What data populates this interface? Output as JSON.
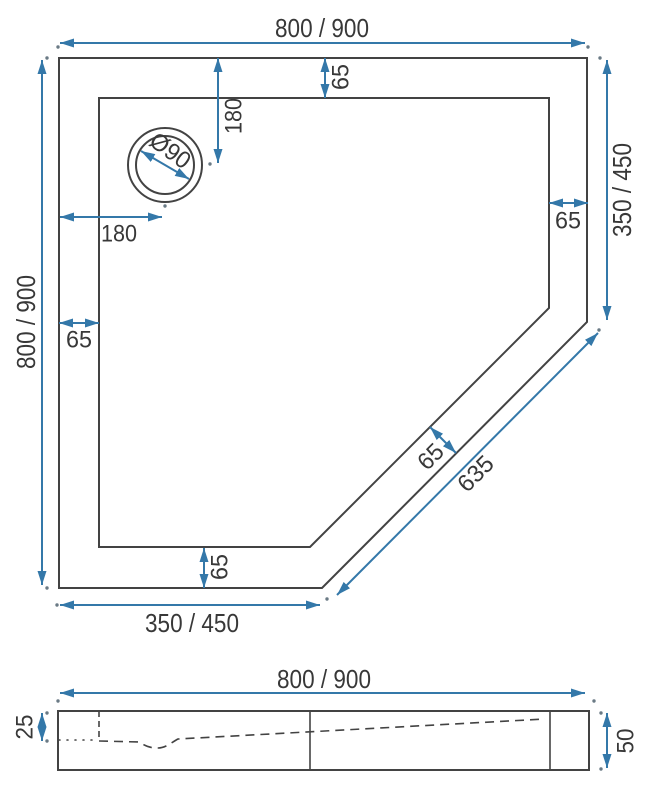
{
  "drawing": {
    "title": "Pentagonal shower tray technical dimension drawing",
    "colors": {
      "dimension_blue": "#3478a9",
      "outline_gray": "#434343",
      "text": "#383838",
      "background": "#ffffff"
    },
    "views": {
      "top": {
        "outer_width": "800 / 900",
        "outer_height": "800 / 900",
        "right_edge_length": "350 / 450",
        "bottom_edge_length": "350 / 450",
        "diagonal_edge_length": "635",
        "rim_width_top": "65",
        "rim_width_left": "65",
        "rim_width_right": "65",
        "rim_width_bottom": "65",
        "rim_width_diagonal": "65",
        "drain_diameter": "Ø90",
        "drain_offset_from_left": "180",
        "drain_offset_from_top": "180"
      },
      "side": {
        "width": "800 / 900",
        "edge_height": "25",
        "total_height": "50"
      }
    }
  }
}
